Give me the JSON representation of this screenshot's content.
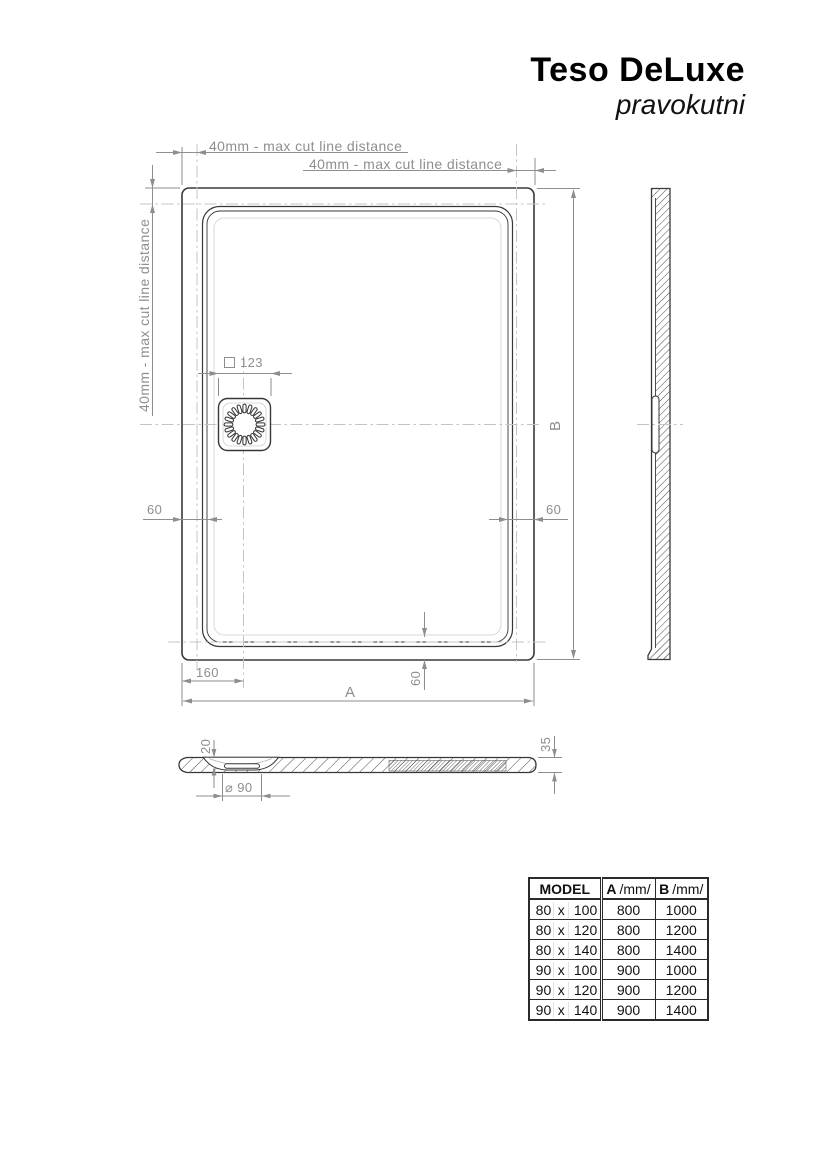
{
  "header": {
    "title": "Teso DeLuxe",
    "subtitle": "pravokutni"
  },
  "annotations": {
    "cut_line_top_left": "40mm - max cut line distance",
    "cut_line_top_right": "40mm - max cut line distance",
    "cut_line_left": "40mm - max cut line distance",
    "drain_size": "123",
    "wall_left": "60",
    "wall_right": "60",
    "drain_offset": "160",
    "wall_bottom": "60",
    "width_label": "A",
    "height_label": "B",
    "depth_label": "20",
    "thickness_label": "35",
    "drain_diameter": "⌀ 90"
  },
  "table": {
    "header": {
      "model": "MODEL",
      "a_name": "A",
      "a_unit": "/mm/",
      "b_name": "B",
      "b_unit": "/mm/"
    },
    "rows": [
      {
        "w": "80",
        "x": "x",
        "l": "100",
        "a": "800",
        "b": "1000"
      },
      {
        "w": "80",
        "x": "x",
        "l": "120",
        "a": "800",
        "b": "1200"
      },
      {
        "w": "80",
        "x": "x",
        "l": "140",
        "a": "800",
        "b": "1400"
      },
      {
        "w": "90",
        "x": "x",
        "l": "100",
        "a": "900",
        "b": "1000"
      },
      {
        "w": "90",
        "x": "x",
        "l": "120",
        "a": "900",
        "b": "1200"
      },
      {
        "w": "90",
        "x": "x",
        "l": "140",
        "a": "900",
        "b": "1400"
      }
    ]
  },
  "colors": {
    "line_dark": "#383838",
    "dimension": "#8e8e8e",
    "faint": "#c4c4c4",
    "text": "#000000"
  }
}
